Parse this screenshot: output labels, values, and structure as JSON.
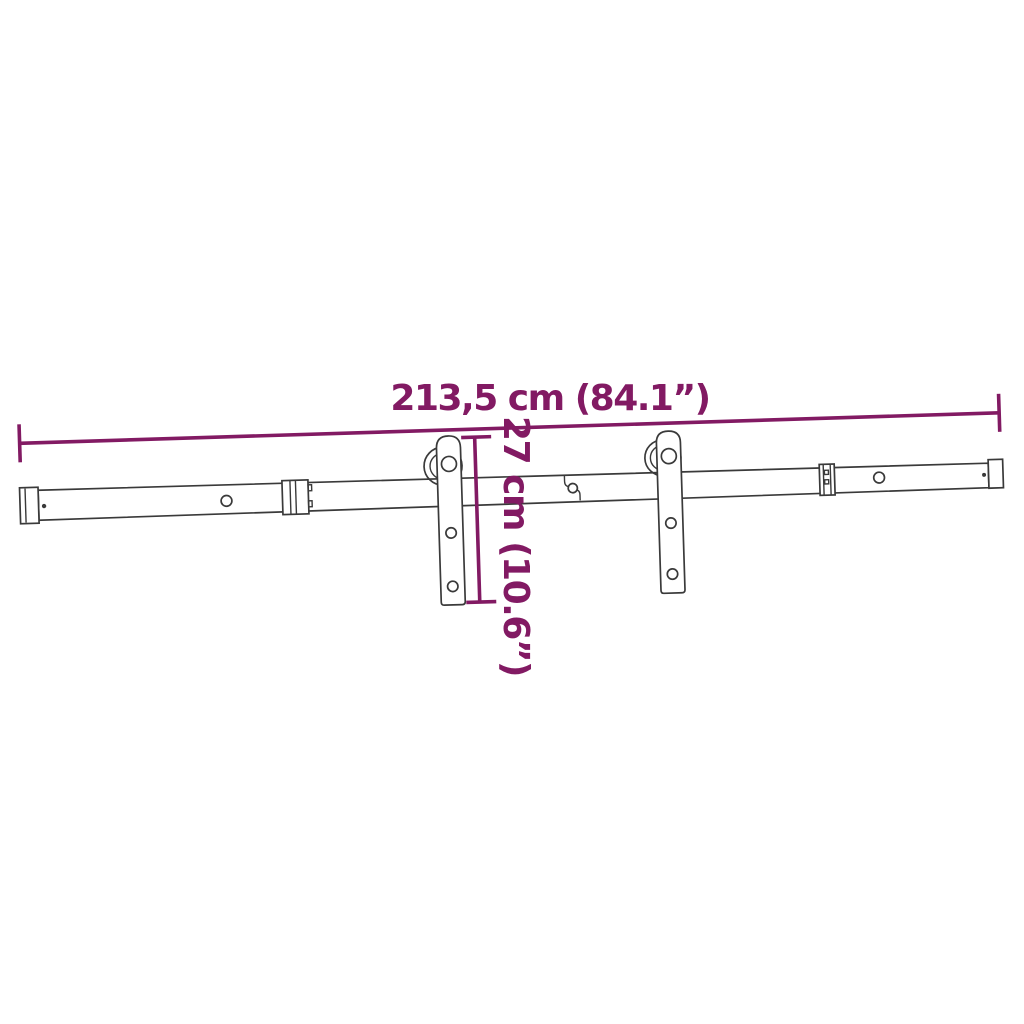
{
  "diagram": {
    "description": "Technical line drawing of a sliding barn door rail hardware kit with two roller hangers and dimension annotations",
    "labels": {
      "horizontal_dimension": "213,5 cm (84.1”)",
      "vertical_dimension": "27 cm (10.6”)"
    },
    "dimensions": {
      "length_cm": "213,5",
      "length_in": "84.1",
      "height_cm": "27",
      "height_in": "10.6"
    },
    "colors": {
      "accent": "#821A63",
      "line": "#3A3A3A",
      "fill": "#FFFFFF"
    }
  }
}
